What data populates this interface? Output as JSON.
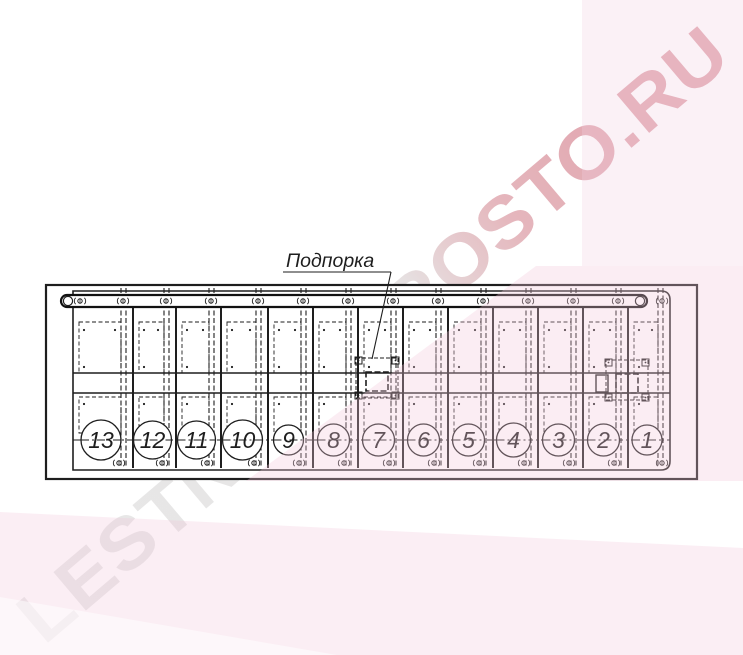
{
  "drawing": {
    "support_label": "Подпорка",
    "treads": [
      {
        "number": "13"
      },
      {
        "number": "12"
      },
      {
        "number": "11"
      },
      {
        "number": "10"
      },
      {
        "number": "9"
      },
      {
        "number": "8"
      },
      {
        "number": "7"
      },
      {
        "number": "6"
      },
      {
        "number": "5"
      },
      {
        "number": "4"
      },
      {
        "number": "3"
      },
      {
        "number": "2"
      },
      {
        "number": "1"
      }
    ]
  },
  "watermark": {
    "text": "LESTNICY-PROSTO.RU"
  },
  "colors": {
    "line": "#1e1e1e",
    "watermark_gray": "#e6e6e6",
    "watermark_red": "#df9fa9",
    "pink_overlay": "rgba(242,199,219,0.32)",
    "pink_overlay_light": "rgba(243,210,226,0.30)"
  }
}
